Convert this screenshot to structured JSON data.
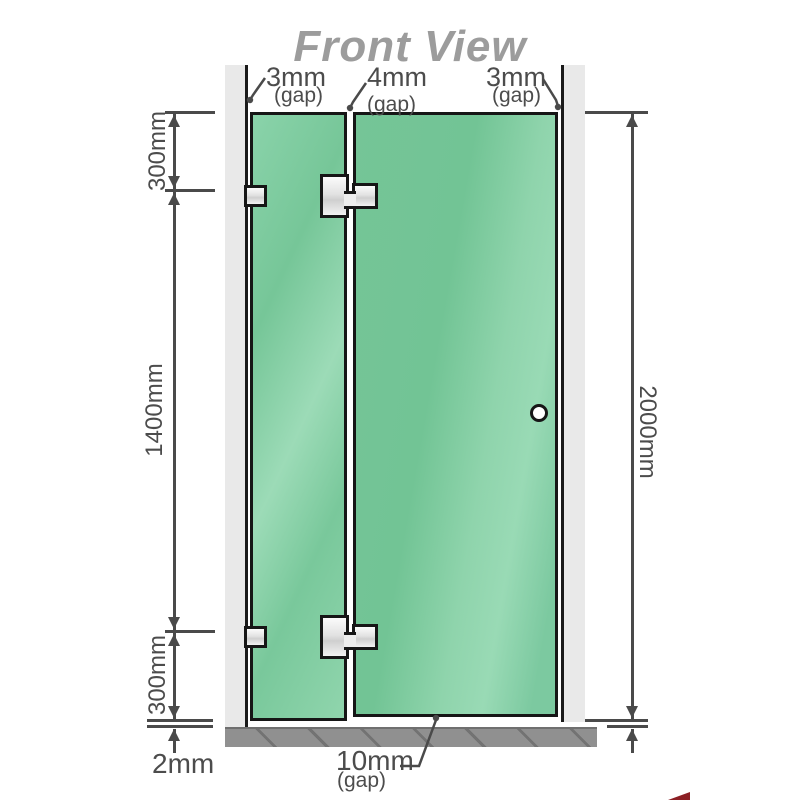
{
  "title": "Front View",
  "dimensions": {
    "left_top": "300mm",
    "left_middle": "1400mm",
    "left_bottom": "300mm",
    "right_total": "2000mm",
    "floor_gap_left": "2mm"
  },
  "gaps": {
    "top_left": {
      "value": "3mm",
      "label": "(gap)"
    },
    "top_center": {
      "value": "4mm",
      "label": "(gap)"
    },
    "top_right": {
      "value": "3mm",
      "label": "(gap)"
    },
    "bottom": {
      "value": "10mm",
      "label": "(gap)"
    }
  },
  "colors": {
    "glass_green": "#76c698",
    "glass_highlight": "#9cdbb7",
    "wall_gray": "#e9e9e9",
    "floor_gray": "#909090",
    "line_dark": "#4a4a4a",
    "outline_black": "#161616",
    "title_gray": "#9c9c9c",
    "watermark_red": "#8c1f24"
  }
}
